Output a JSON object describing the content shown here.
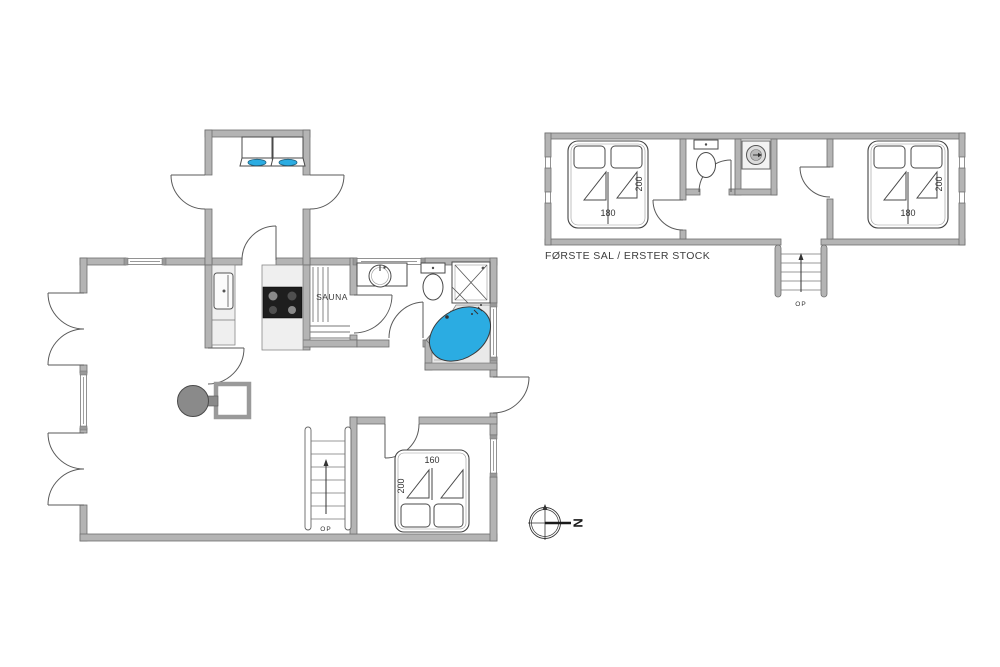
{
  "ground_floor": {
    "sauna_label": "SAUNA",
    "stairs_up_label": "OP",
    "bed": {
      "width_cm": "160",
      "length_cm": "200"
    }
  },
  "first_floor": {
    "caption": "FØRSTE SAL / ERSTER STOCK",
    "stairs_up_label": "OP",
    "bed_left": {
      "width_cm": "180",
      "length_cm": "200"
    },
    "bed_right": {
      "width_cm": "180",
      "length_cm": "200"
    }
  },
  "compass": {
    "north_label": "N"
  },
  "colors": {
    "wall_gray": "#b4b4b4",
    "water_blue": "#2bace2",
    "counter_gray": "#efefef",
    "platform_gray": "#e9e9e9"
  }
}
